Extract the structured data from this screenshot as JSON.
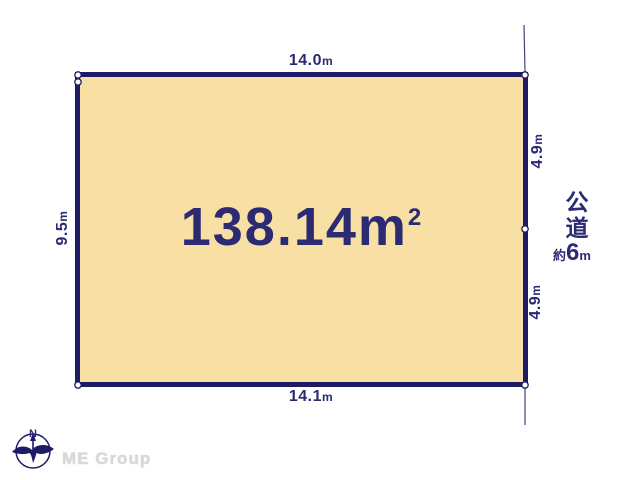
{
  "parcel": {
    "area_value": "138.14m",
    "area_exponent": "2",
    "dimensions": {
      "top": {
        "value": "14.0",
        "unit": "m"
      },
      "bottom": {
        "value": "14.1",
        "unit": "m"
      },
      "left": {
        "value": "9.5",
        "unit": "m"
      },
      "right_upper": {
        "value": "4.9",
        "unit": "m"
      },
      "right_lower": {
        "value": "4.9",
        "unit": "m"
      }
    }
  },
  "road": {
    "name": "公道",
    "width_prefix": "約",
    "width_value": "6",
    "width_unit": "m"
  },
  "compass": {
    "north": "N"
  },
  "branding": {
    "company": "ME Group"
  },
  "colors": {
    "parcel_fill": "#f8dfa4",
    "boundary_navy": "#1e1b66",
    "text_navy": "#2b2a72",
    "logo_gray": "#d9d9d9"
  }
}
